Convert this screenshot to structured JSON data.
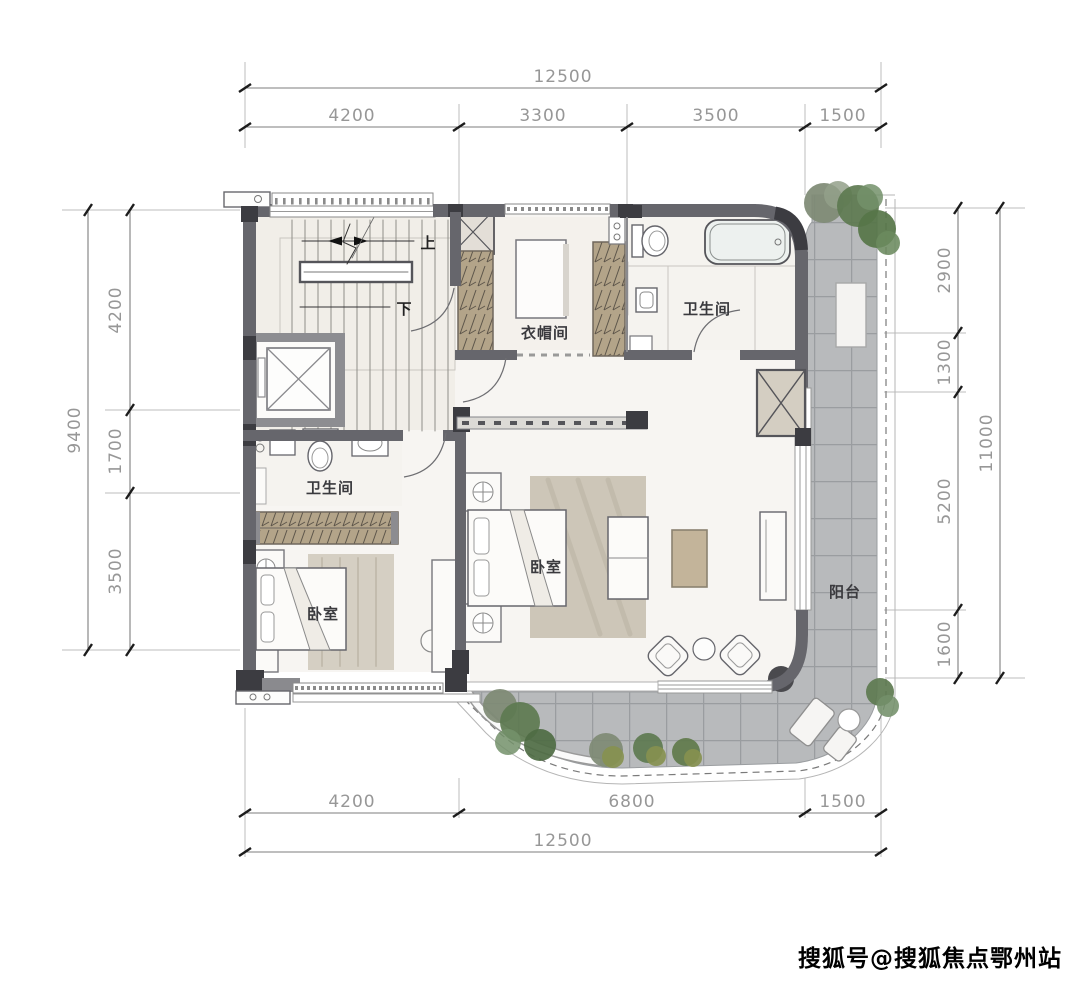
{
  "dimensions": {
    "top": {
      "overall": "12500",
      "segments": [
        "4200",
        "3300",
        "3500",
        "1500"
      ]
    },
    "bottom": {
      "overall": "12500",
      "segments": [
        "4200",
        "6800",
        "1500"
      ]
    },
    "left": {
      "overall": "9400",
      "segments": [
        "4200",
        "1700",
        "3500"
      ]
    },
    "right": {
      "overall": "11000",
      "segments": [
        "2900",
        "1300",
        "5200",
        "1600"
      ]
    }
  },
  "rooms": {
    "cloakroom": "衣帽间",
    "bathroom_top": "卫生间",
    "bathroom_left": "卫生间",
    "bedroom_master": "卧室",
    "bedroom_second": "卧室",
    "balcony": "阳台"
  },
  "stairs": {
    "up": "上",
    "down": "下"
  },
  "watermark": {
    "text": "搜狐号@搜狐焦点鄂州站"
  },
  "colors": {
    "wall": "#66666c",
    "wall_dark": "#3c3c41",
    "tile": "#b8babc",
    "wardrobe": "#b3a489",
    "floor": "#f7f5f2",
    "tree": "#5d7a50"
  }
}
